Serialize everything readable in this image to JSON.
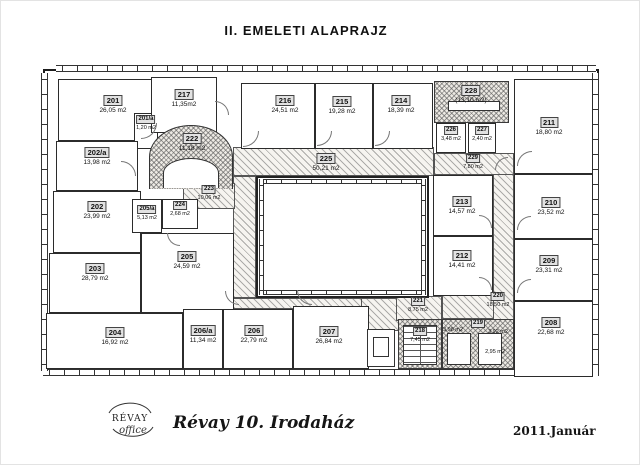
{
  "title": "II. EMELETI ALAPRAJZ",
  "footer": {
    "logo_top": "RÉVAY",
    "logo_script": "office",
    "building_name": "Révay 10. Irodaház",
    "date": "2011.Január"
  },
  "wc_areas": [
    "3,98 m2",
    "3,92 m2",
    "2,95 m2"
  ],
  "rooms": {
    "r201": {
      "number": "201",
      "area": "26,05 m2"
    },
    "r201a": {
      "number": "201/a",
      "area": "1,20 m2"
    },
    "r202a": {
      "number": "202/a",
      "area": "13,98 m2"
    },
    "r202": {
      "number": "202",
      "area": "23,99 m2"
    },
    "r203": {
      "number": "203",
      "area": "28,79 m2"
    },
    "r204": {
      "number": "204",
      "area": "16,92 m2"
    },
    "r205a": {
      "number": "205/a",
      "area": "5,13 m2"
    },
    "r205": {
      "number": "205",
      "area": "24,59 m2"
    },
    "r206a": {
      "number": "206/a",
      "area": "11,34 m2"
    },
    "r206": {
      "number": "206",
      "area": "22,79 m2"
    },
    "r207": {
      "number": "207",
      "area": "26,84 m2"
    },
    "r208": {
      "number": "208",
      "area": "22,68 m2"
    },
    "r209": {
      "number": "209",
      "area": "23,31 m2"
    },
    "r210": {
      "number": "210",
      "area": "23,52 m2"
    },
    "r211": {
      "number": "211",
      "area": "18,80 m2"
    },
    "r212": {
      "number": "212",
      "area": "14,41 m2"
    },
    "r213": {
      "number": "213",
      "area": "14,57 m2"
    },
    "r214": {
      "number": "214",
      "area": "18,39 m2"
    },
    "r215": {
      "number": "215",
      "area": "19,28 m2"
    },
    "r216": {
      "number": "216",
      "area": "24,51 m2"
    },
    "r217": {
      "number": "217",
      "area": "11,35m2"
    },
    "r218": {
      "number": "218",
      "area": "7,45 m2"
    },
    "r219": {
      "number": "219",
      "area": ""
    },
    "r220": {
      "number": "220",
      "area": "18,50 m2"
    },
    "r221": {
      "number": "221",
      "area": "8,75 m2"
    },
    "r222": {
      "number": "222",
      "area": "11,18 m2"
    },
    "r223": {
      "number": "223",
      "area": "10,06 m2"
    },
    "r224": {
      "number": "224",
      "area": "2,68 m2"
    },
    "r225": {
      "number": "225",
      "area": "50,21 m2"
    },
    "r226": {
      "number": "226",
      "area": "3,48 m2"
    },
    "r227": {
      "number": "227",
      "area": "2,40 m2"
    },
    "r228": {
      "number": "228",
      "area": "(13,10 m2)"
    },
    "r229": {
      "number": "229",
      "area": "7,80 m2"
    }
  }
}
